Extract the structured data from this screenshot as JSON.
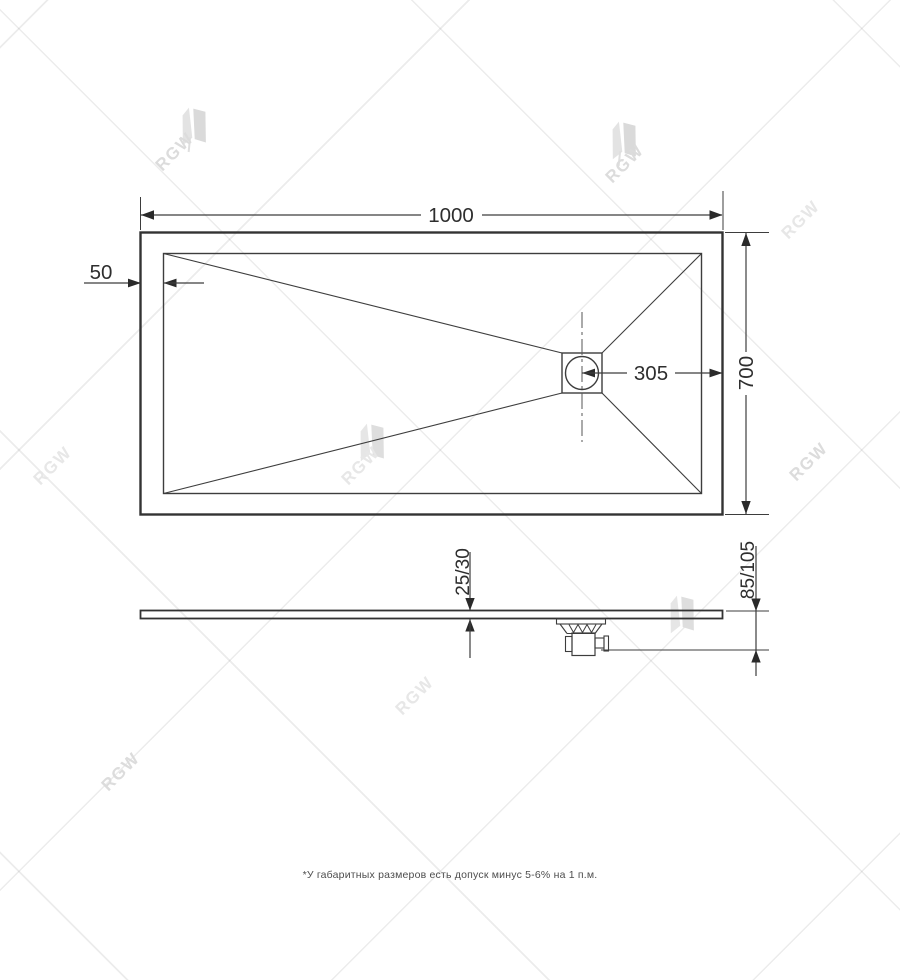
{
  "watermark": {
    "text": "RGW"
  },
  "views": {
    "top": {
      "width_label": "1000",
      "rim_width_label": "50",
      "drain_offset_label": "305",
      "depth_label": "700"
    },
    "side": {
      "thickness_label": "25/30",
      "height_with_drain_label": "85/105"
    }
  },
  "footnote": "*У габаритных размеров есть допуск минус 5-6% на 1 п.м.",
  "colors": {
    "line": "#3d3d3d",
    "dimension_text": "#2e2e2e",
    "watermark": "#dcdcdc",
    "background": "#ffffff"
  }
}
